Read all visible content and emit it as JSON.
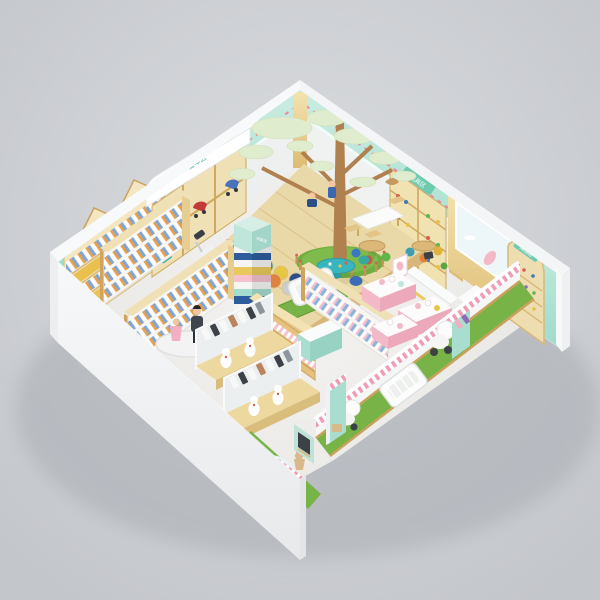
{
  "meta": {
    "title": "Isometric 3D render of a mother & baby kids store interior",
    "canvas": "600x600"
  },
  "palette": {
    "background": "#ced1d5",
    "wall_white": "#f3f4f5",
    "wall_interior": "#edefef",
    "mint": "#aee0d2",
    "wood": "#e9cc84",
    "wood_light": "#f3e3b4",
    "wood_dark": "#cfa45c",
    "floor": "#f1f0ee",
    "grass": "#77b347",
    "turf": "#6fae3f",
    "teal": "#38b6be",
    "pink": "#f3b9c8",
    "pink_stripe": "#ef9db7",
    "navy": "#2e5d9e",
    "orange": "#e0793c",
    "red": "#c24836",
    "canopy": "#dfeccd",
    "trunk": "#b0804e",
    "sign_green": "#5fc3a5"
  },
  "signs": {
    "milk_powder_zone": "奶粉区",
    "stroller_zone": "童车区",
    "toy_zone": "玩具区",
    "alcove_zone": "用品区",
    "tower_label": "母婴馆"
  },
  "areas": [
    {
      "name": "tree-play-area",
      "description": "Raised wooden platform with sculpted tree, pale-green canopies, picket-fenced grass ring, white kids table with chairs, hexagon pads"
    },
    {
      "name": "milk-powder-shelves",
      "description": "House-shaped wooden wall shelves with formula cans and baby posters under mint fascia"
    },
    {
      "name": "stroller-display",
      "description": "White awning wall bay with cubbies holding blue and red strollers"
    },
    {
      "name": "toy-wall-shelves",
      "description": "Tall wooden toy shelf and arched alcove shelf on mint wall, light-blue bunny poster on wood panel"
    },
    {
      "name": "checkout-counter",
      "description": "White cashier counter with monitor and plant"
    },
    {
      "name": "book-tower",
      "description": "Striped stacked column with mint signage cube"
    },
    {
      "name": "gondola-shelves",
      "description": "Wood and white gondolas stocked with bottles and jars"
    },
    {
      "name": "clothing-displays",
      "description": "Pink display tables with baby clothes; garment rows with white romper forms and mirrors"
    },
    {
      "name": "mannequin-platform",
      "description": "Adult and child mannequins on a round white base"
    },
    {
      "name": "reading-corner",
      "description": "Teal round table with colorful poufs and wooden kids tables with stools"
    },
    {
      "name": "nursery-lawn",
      "description": "Green turf strip along the open front edge with white crib and prams"
    },
    {
      "name": "garden-vignette",
      "description": "Turf corner with pond, stacked white cans, plywood rabbit, chalkboard panel and picket fence"
    }
  ]
}
